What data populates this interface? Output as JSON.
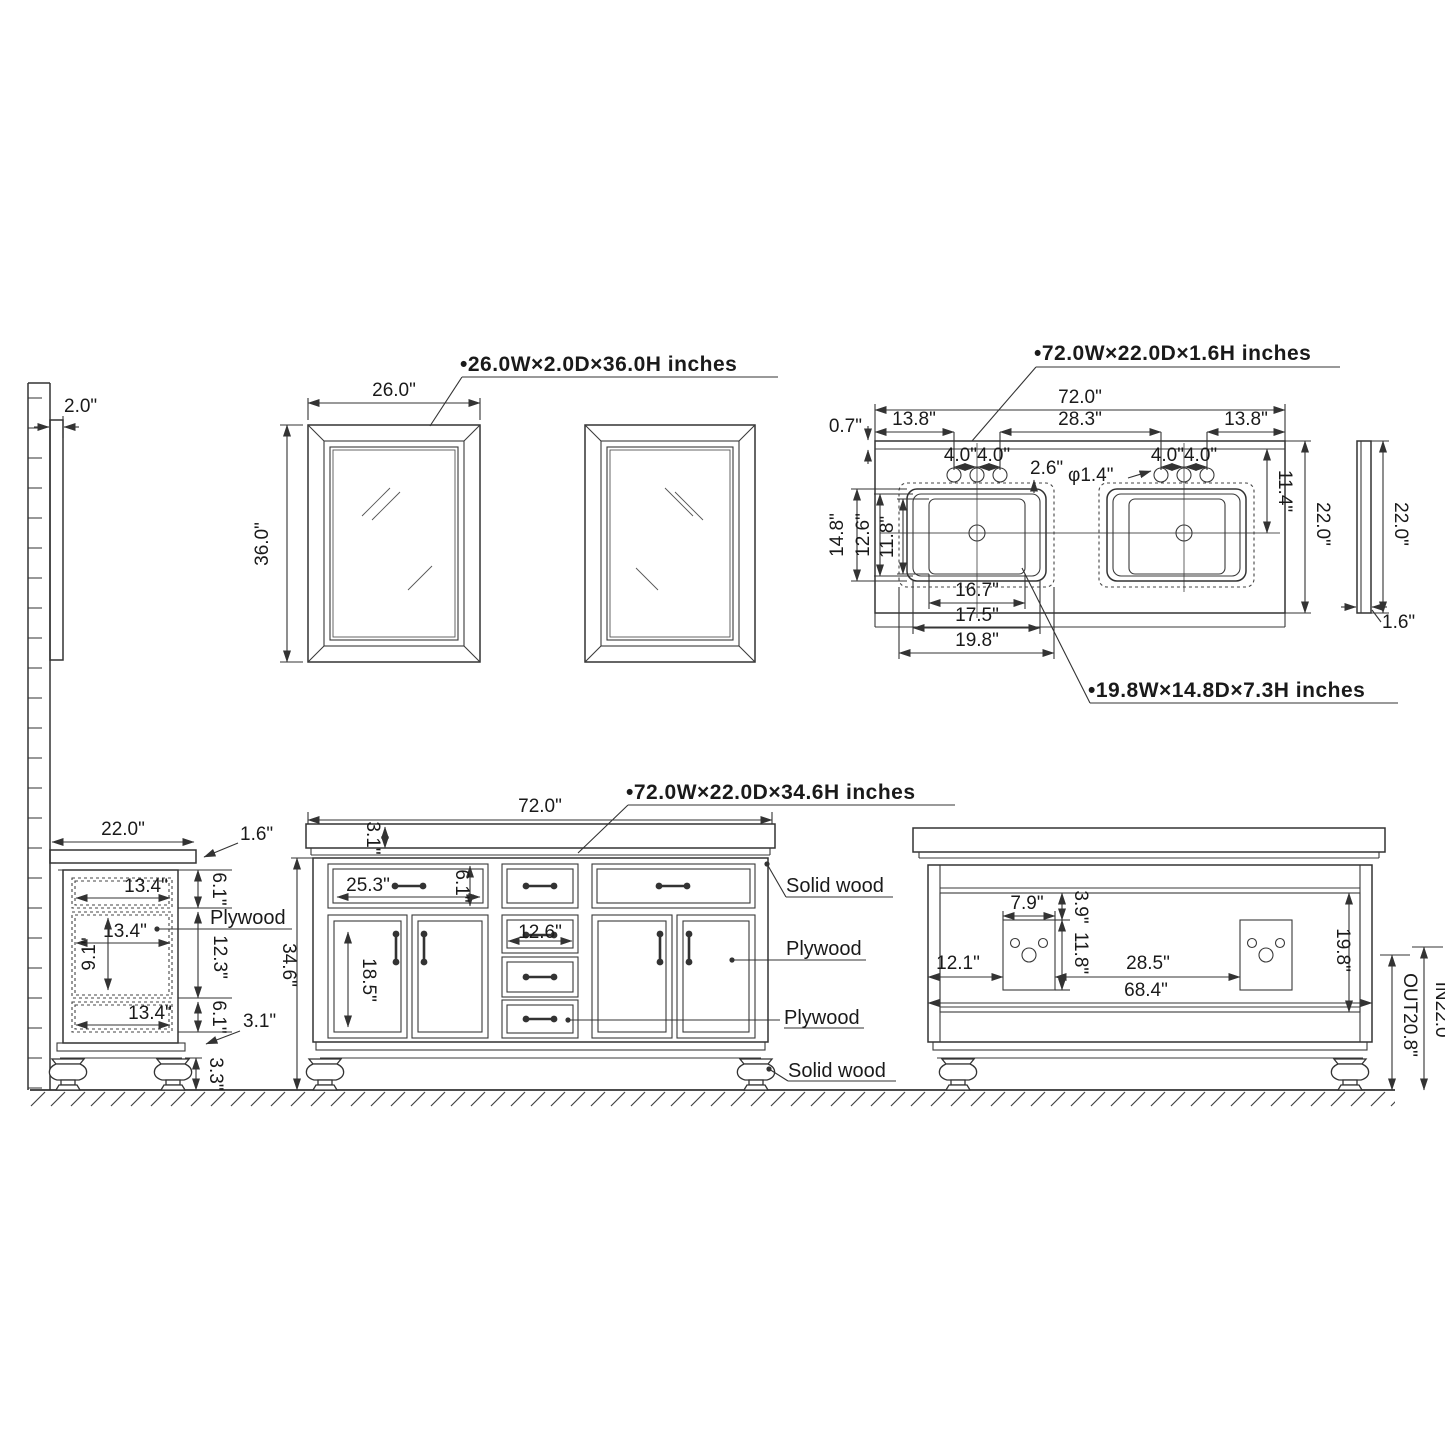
{
  "labels": {
    "mirror_spec": "•26.0W×2.0D×36.0H inches",
    "countertop_spec": "•72.0W×22.0D×1.6H inches",
    "sink_spec": "•19.8W×14.8D×7.3H inches",
    "vanity_spec": "•72.0W×22.0D×34.6H inches"
  },
  "mirror": {
    "depth": "2.0\"",
    "width": "26.0\"",
    "height": "36.0\""
  },
  "countertop": {
    "width": "72.0\"",
    "back_offset": "0.7\"",
    "left_edge_to_faucet": "13.8\"",
    "right_edge_to_faucet": "13.8\"",
    "faucet_spacing_left": "4.0\"4.0\"",
    "faucet_spacing_right": "4.0\"4.0\"",
    "between_faucets": "28.3\"",
    "faucet_to_sink": "2.6\"",
    "faucet_hole_dia": "φ1.4\"",
    "backsplash_to_sink_center": "11.4\"",
    "depth": "22.0\"",
    "side_depth": "22.0\"",
    "thickness": "1.6\"",
    "sink_outer_depth": "14.8\"",
    "sink_mid_depth": "12.6\"",
    "sink_basin_depth": "11.8\"",
    "sink_basin_width": "16.7\"",
    "sink_mid_width": "17.5\"",
    "sink_outer_width": "19.8\""
  },
  "side_view": {
    "depth": "22.0\"",
    "counter_thickness": "1.6\"",
    "top_drawer_height": "6.1\"",
    "top_drawer_depth": "13.4\"",
    "mid_depth": "13.4\"",
    "mid_inner_height": "9.1\"",
    "mid_height": "12.3\"",
    "bottom_depth": "13.4\"",
    "bottom_height": "6.1\"",
    "rail_height": "3.1\"",
    "foot_height": "3.3\"",
    "material": "Plywood"
  },
  "front_view": {
    "width": "72.0\"",
    "counter_thickness": "3.1\"",
    "height": "34.6\"",
    "drawer_width": "25.3\"",
    "drawer_height": "6.1\"",
    "door_height": "18.5\"",
    "center_width": "12.6\"",
    "mat_top": "Solid wood",
    "mat_door": "Plywood",
    "mat_drawer": "Plywood",
    "mat_leg": "Solid wood"
  },
  "back_view": {
    "cutout_width": "7.9\"",
    "cutout_top_offset": "3.9\"",
    "cutout_height": "11.8\"",
    "left_margin": "12.1\"",
    "cutout_gap": "28.5\"",
    "inner_width": "68.4\"",
    "panel_height": "19.8\"",
    "drain_out": "OUT20.8\"",
    "supply_in": "IN22.0\""
  }
}
